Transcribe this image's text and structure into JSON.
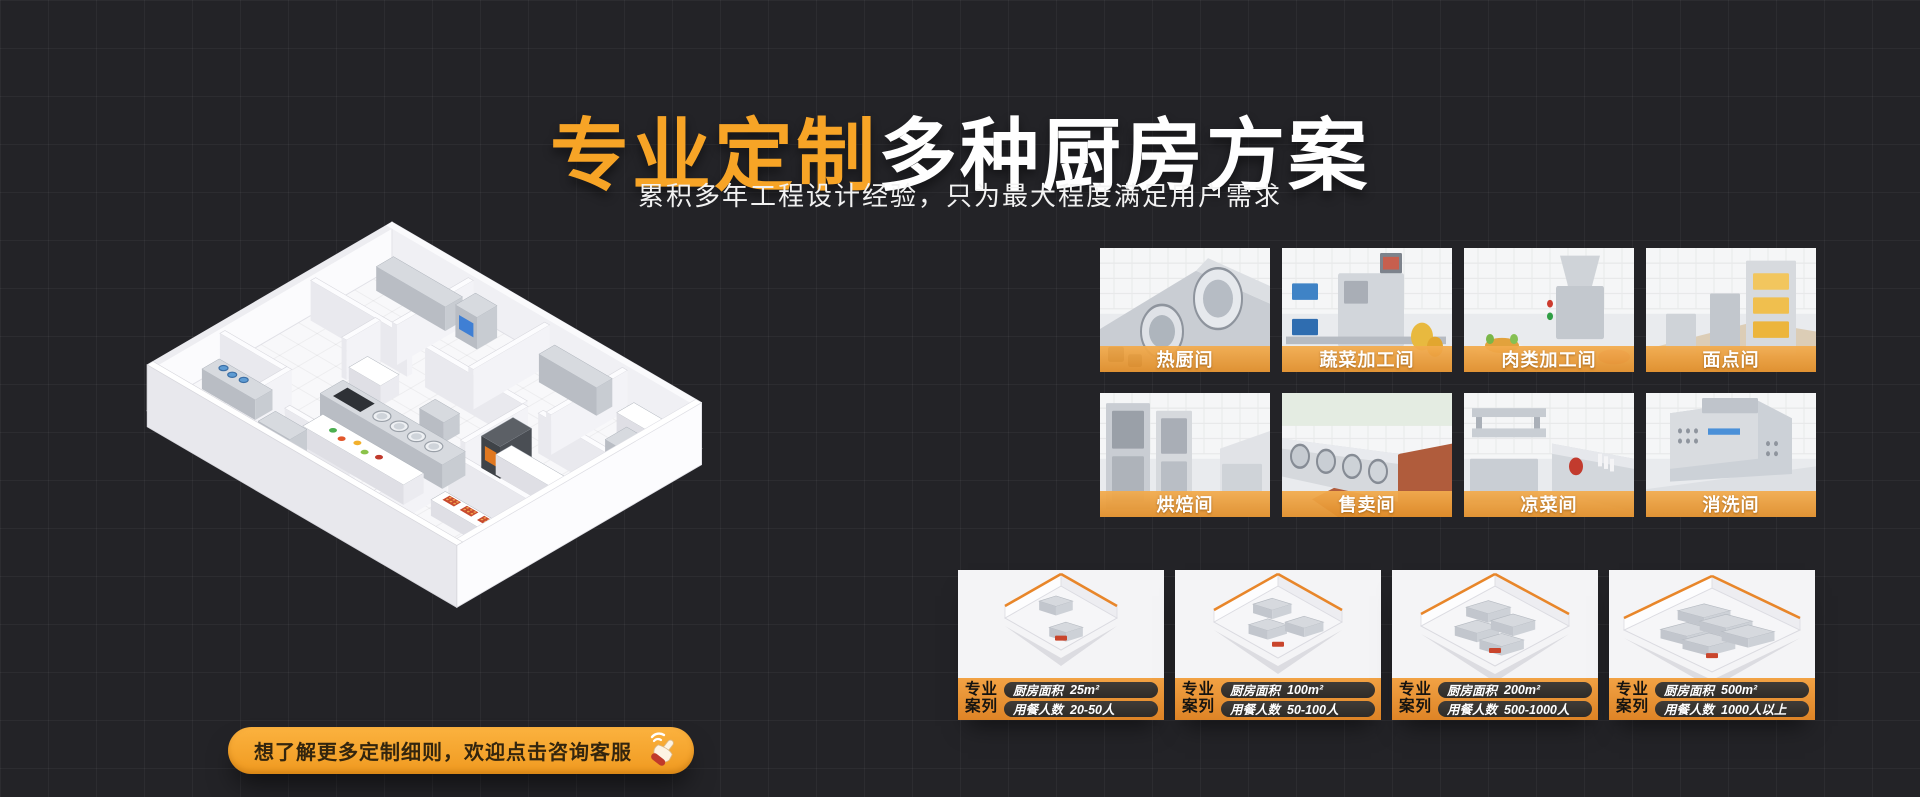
{
  "header": {
    "title_highlight": "专业定制",
    "title_rest": "多种厨房方案",
    "subtitle": "累积多年工程设计经验，只为最大程度满足用户需求"
  },
  "floorplan": {
    "description": "isometric-3d-kitchen-floorplan"
  },
  "rooms": {
    "items": [
      {
        "label": "热厨间"
      },
      {
        "label": "蔬菜加工间"
      },
      {
        "label": "肉类加工间"
      },
      {
        "label": "面点间"
      },
      {
        "label": "烘焙间"
      },
      {
        "label": "售卖间"
      },
      {
        "label": "凉菜间"
      },
      {
        "label": "消洗间"
      }
    ]
  },
  "cases": {
    "badge_line1": "专业",
    "badge_line2": "案列",
    "area_label": "厨房面积",
    "diners_label": "用餐人数",
    "items": [
      {
        "area": "25m²",
        "diners": "20-50人"
      },
      {
        "area": "100m²",
        "diners": "50-100人"
      },
      {
        "area": "200m²",
        "diners": "500-1000人"
      },
      {
        "area": "500m²",
        "diners": "1000人以上"
      }
    ]
  },
  "cta": {
    "label": "想了解更多定制细则，欢迎点击咨询客服",
    "icon": "click-hand-icon"
  },
  "colors": {
    "background": "#232327",
    "accent_orange": "#F7A426",
    "room_label_orange": "#E9952F",
    "case_bar_orange": "#EE9838",
    "pill_dark": "#353230",
    "text_white": "#FFFFFF"
  }
}
